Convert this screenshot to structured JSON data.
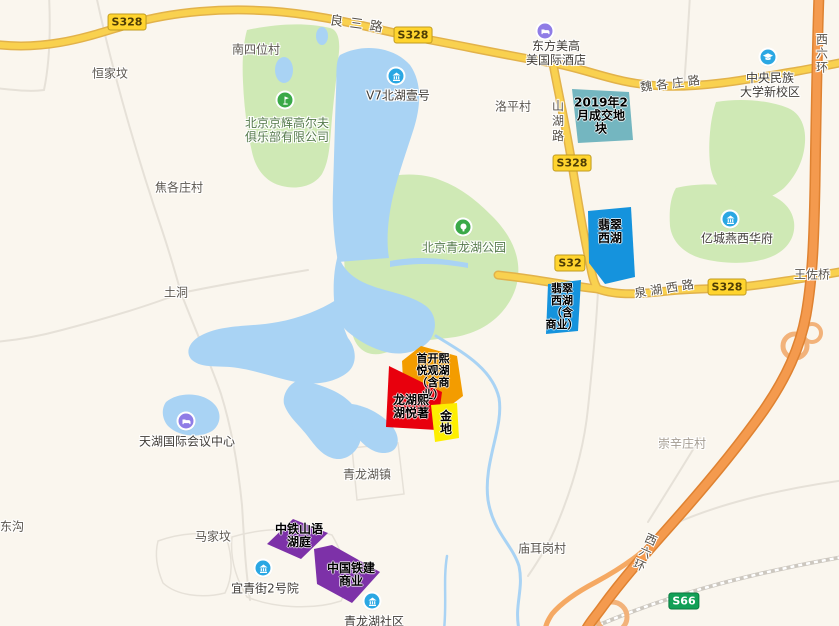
{
  "colors": {
    "water": "#a9d3f4",
    "green_area": "#cfe9b5",
    "road_yellow": "#f9d14f",
    "highway_orange": "#f49a4e"
  },
  "roads": {
    "liangsanlu": "良三路",
    "weigezhuanglu": "魏各庄路",
    "quanhuxilu": "泉湖西路",
    "shanhulu": "山湖路",
    "xiliuhuan": "西六环"
  },
  "badges": {
    "s328": "S328",
    "s328_partial": "S32",
    "s66": "S66"
  },
  "villages": {
    "nansiwei": "南四位村",
    "hengjiafen": "恒家坟",
    "jiaogezhuang": "焦各庄村",
    "tudong": "土洞",
    "luoping": "洛平村",
    "chongxinzhuang": "崇辛庄村",
    "miaoergang": "庙耳岗村",
    "majiafen": "马家坟",
    "donggou": "东沟",
    "qinglonghuzhen": "青龙湖镇",
    "wangzuoqiao": "王佐桥"
  },
  "pois": {
    "v7_beihu": {
      "name": "V7北湖壹号",
      "icon": "building-icon"
    },
    "dongfang_hotel": {
      "line1": "东方美高",
      "line2": "美国际酒店",
      "icon": "hotel-icon"
    },
    "minzu_university": {
      "line1": "中央民族",
      "line2": "大学新校区",
      "icon": "school-icon"
    },
    "yicheng": {
      "name": "亿城燕西华府",
      "icon": "building-icon"
    },
    "qinglonghu_park": {
      "name": "北京青龙湖公园",
      "icon": "tree-icon"
    },
    "golf_club": {
      "line1": "北京京辉高尔夫",
      "line2": "俱乐部有限公司",
      "icon": "golf-icon"
    },
    "tianhu_center": {
      "name": "天湖国际会议中心",
      "icon": "hotel-icon"
    },
    "yiqingjie": {
      "name": "宜青街2号院",
      "icon": "building-icon"
    },
    "qinglonghu_shequ": {
      "name": "青龙湖社区",
      "icon": "building-icon"
    }
  },
  "parcels": {
    "deal_2019": {
      "color": "#74b6c0",
      "lines": [
        "2019年2",
        "月成交地",
        "块"
      ]
    },
    "feicui_xihu": {
      "color": "#1593dd",
      "lines": [
        "翡翠",
        "西湖"
      ]
    },
    "feicui_xihu_biz": {
      "color": "#1593dd",
      "lines": [
        "翡翠",
        "西湖",
        "（含",
        "商业）"
      ]
    },
    "shoukai_xiyue": {
      "color": "#f39c00",
      "lines": [
        "首开熙",
        "悦观湖",
        "（含商",
        "业）"
      ]
    },
    "longhu_xihu": {
      "color": "#e8000d",
      "lines": [
        "龙湖熙",
        "湖悦著"
      ]
    },
    "jindi": {
      "color": "#fdee00",
      "lines": [
        "金",
        "地"
      ]
    },
    "zhongtie_shanyu": {
      "color": "#7d31a8",
      "lines": [
        "中铁山语",
        "湖庭"
      ]
    },
    "tiejian_biz": {
      "color": "#7d31a8",
      "lines": [
        "中国铁建",
        "商业"
      ]
    }
  }
}
